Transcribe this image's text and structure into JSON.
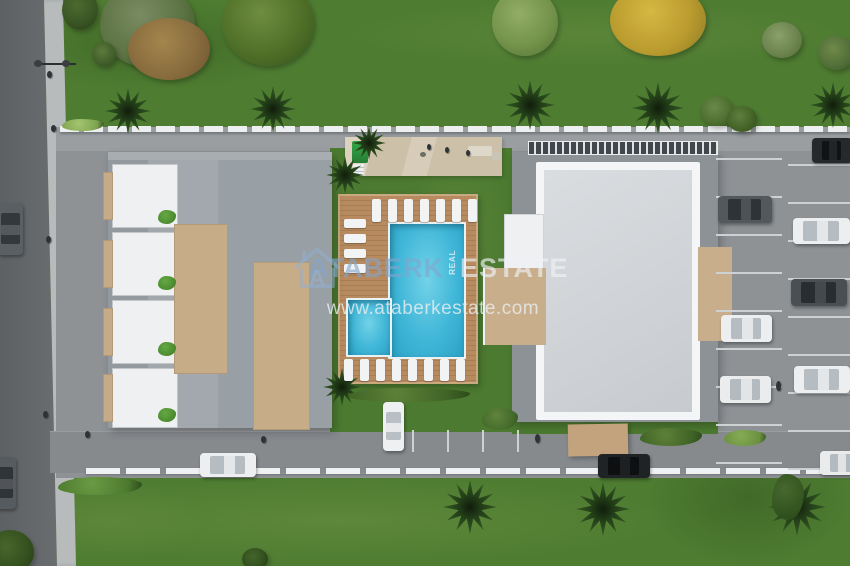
{
  "watermark": {
    "brand_first": "ATABERK",
    "brand_mid_vertical": "REAL",
    "brand_last": "ESTATE",
    "website": "www.ataberkestate.com",
    "logo_letter": "A",
    "brand_first_color": "#82a5cd",
    "brand_last_color": "#eef2f6"
  },
  "scene": {
    "type": "aerial-3d-site-plan-render",
    "description": "Top-down 3D rendering of a residential complex: two buildings, main pool and children's pool on a wooden sun deck with loungers, amenity terrace, parking lots with cars, perimeter roads, lawns, palms and trees",
    "buildings_visible": 2,
    "pools_visible": 2,
    "cars_visible": 13
  },
  "palette": {
    "lawn": "#4e7c31",
    "street": "#66696c",
    "sidewalk": "#b8bbbc",
    "paving": "#8e9295",
    "deck_wood": "#b5885c",
    "pool_water": "#41b7d8",
    "roof_gray": "#9aa0a5",
    "roof_light": "#d4d7da",
    "terrace_tan": "#c9ae8b",
    "fence_white": "#eef0f1"
  },
  "sprites": [
    {
      "cls": "car car-v",
      "name": "car",
      "x": -2,
      "y": 203,
      "w": 25,
      "h": 52,
      "c1": "#5a5f63",
      "cw": "#33383c"
    },
    {
      "cls": "car car-v",
      "name": "car",
      "x": -9,
      "y": 457,
      "w": 25,
      "h": 52,
      "c1": "#565b5f",
      "cw": "#2f3438"
    },
    {
      "cls": "car car-v",
      "name": "car",
      "x": 383,
      "y": 402,
      "w": 21,
      "h": 49,
      "c1": "#eef0f1",
      "cw": "#b9c0c5"
    },
    {
      "cls": "car car-h",
      "name": "car",
      "x": 200,
      "y": 453,
      "w": 56,
      "h": 24,
      "c1": "#eceef0",
      "cw": "#b6bdc2"
    },
    {
      "cls": "car car-h",
      "name": "car",
      "x": 598,
      "y": 454,
      "w": 52,
      "h": 24,
      "c1": "#202326",
      "cw": "#0d0f11"
    },
    {
      "cls": "car car-h",
      "name": "car",
      "x": 820,
      "y": 451,
      "w": 42,
      "h": 24,
      "c1": "#e9ebed",
      "cw": "#b4bbc0"
    },
    {
      "cls": "car car-h",
      "name": "car",
      "x": 718,
      "y": 196,
      "w": 54,
      "h": 27,
      "c1": "#53585c",
      "cw": "#2e3337"
    },
    {
      "cls": "car car-h",
      "name": "car",
      "x": 721,
      "y": 315,
      "w": 51,
      "h": 27,
      "c1": "#eceef0",
      "cw": "#b6bdc2"
    },
    {
      "cls": "car car-h",
      "name": "car",
      "x": 720,
      "y": 376,
      "w": 51,
      "h": 27,
      "c1": "#eaecee",
      "cw": "#b4bbc0"
    },
    {
      "cls": "car car-h",
      "name": "car",
      "x": 812,
      "y": 138,
      "w": 40,
      "h": 25,
      "c1": "#26292c",
      "cw": "#101214"
    },
    {
      "cls": "car car-h",
      "name": "car",
      "x": 793,
      "y": 218,
      "w": 57,
      "h": 26,
      "c1": "#eceef0",
      "cw": "#b6bdc2"
    },
    {
      "cls": "car car-h",
      "name": "car",
      "x": 791,
      "y": 279,
      "w": 56,
      "h": 27,
      "c1": "#4a4f53",
      "cw": "#282d31"
    },
    {
      "cls": "car car-h",
      "name": "car",
      "x": 794,
      "y": 366,
      "w": 56,
      "h": 27,
      "c1": "#eceef0",
      "cw": "#b6bdc2"
    },
    {
      "cls": "palm",
      "name": "palm-tree",
      "x": 105,
      "y": 88,
      "w": 46,
      "h": 46
    },
    {
      "cls": "palm",
      "name": "palm-tree",
      "x": 250,
      "y": 86,
      "w": 46,
      "h": 46
    },
    {
      "cls": "palm",
      "name": "palm-tree",
      "x": 352,
      "y": 126,
      "w": 34,
      "h": 34
    },
    {
      "cls": "palm",
      "name": "palm-tree",
      "x": 505,
      "y": 80,
      "w": 50,
      "h": 50
    },
    {
      "cls": "palm",
      "name": "palm-tree",
      "x": 632,
      "y": 82,
      "w": 52,
      "h": 52
    },
    {
      "cls": "palm",
      "name": "palm-tree",
      "x": 810,
      "y": 82,
      "w": 46,
      "h": 46
    },
    {
      "cls": "palm",
      "name": "palm-tree",
      "x": 326,
      "y": 156,
      "w": 38,
      "h": 38
    },
    {
      "cls": "palm",
      "name": "palm-tree",
      "x": 323,
      "y": 368,
      "w": 38,
      "h": 38
    },
    {
      "cls": "palm",
      "name": "palm-tree",
      "x": 443,
      "y": 480,
      "w": 54,
      "h": 54
    },
    {
      "cls": "palm",
      "name": "palm-tree",
      "x": 576,
      "y": 482,
      "w": 54,
      "h": 54
    },
    {
      "cls": "palm",
      "name": "palm-tree",
      "x": 768,
      "y": 478,
      "w": 58,
      "h": 58
    },
    {
      "cls": "tree",
      "name": "tree",
      "x": 100,
      "y": -18,
      "w": 95,
      "h": 85,
      "c1": "#5d7444",
      "c2": "#7a8b62",
      "c3": "#3d5226"
    },
    {
      "cls": "tree",
      "name": "autumn-tree",
      "x": 128,
      "y": 18,
      "w": 82,
      "h": 62,
      "c1": "#8a6d3e",
      "c2": "#a3854d",
      "c3": "#6b5430"
    },
    {
      "cls": "tree",
      "name": "tree",
      "x": 222,
      "y": -20,
      "w": 92,
      "h": 86,
      "c1": "#4f7028",
      "c2": "#6f8d40",
      "c3": "#35511b"
    },
    {
      "cls": "tree",
      "name": "tree",
      "x": 492,
      "y": -12,
      "w": 66,
      "h": 68,
      "c1": "#74934b",
      "c2": "#93ad66",
      "c3": "#527334"
    },
    {
      "cls": "tree",
      "name": "yellow-tree",
      "x": 610,
      "y": -16,
      "w": 96,
      "h": 72,
      "c1": "#bb9c2f",
      "c2": "#d4b842",
      "c3": "#8f7a24"
    },
    {
      "cls": "tree",
      "name": "bush",
      "x": 762,
      "y": 22,
      "w": 40,
      "h": 36,
      "c1": "#6d8550",
      "c2": "#8ba06b",
      "c3": "#4f6a38"
    },
    {
      "cls": "tree",
      "name": "bush",
      "x": 818,
      "y": 36,
      "w": 36,
      "h": 34,
      "c1": "#54713a",
      "c2": "#70894a",
      "c3": "#3a5526"
    },
    {
      "cls": "tree",
      "name": "small-tree",
      "x": 92,
      "y": 42,
      "w": 24,
      "h": 24,
      "c1": "#44602c",
      "c2": "#5d7a3c",
      "c3": "#2f4a1e"
    },
    {
      "cls": "tree",
      "name": "small-tree",
      "x": 62,
      "y": -10,
      "w": 36,
      "h": 40,
      "c1": "#3a5524",
      "c2": "#4c6a30",
      "c3": "#283e18"
    },
    {
      "cls": "tree",
      "name": "bush",
      "x": 700,
      "y": 96,
      "w": 34,
      "h": 30,
      "c1": "#4e7030",
      "c2": "#68894a",
      "c3": "#365021"
    },
    {
      "cls": "tree",
      "name": "bush",
      "x": 727,
      "y": 106,
      "w": 30,
      "h": 26,
      "c1": "#456428",
      "c2": "#5d7f3e",
      "c3": "#2e481c"
    },
    {
      "cls": "tree",
      "name": "tree",
      "x": -14,
      "y": 530,
      "w": 48,
      "h": 44,
      "c1": "#35511f",
      "c2": "#47662c",
      "c3": "#223a12"
    },
    {
      "cls": "tree",
      "name": "bush",
      "x": 242,
      "y": 548,
      "w": 26,
      "h": 22,
      "c1": "#33501e",
      "c2": "#45652c",
      "c3": "#203812"
    },
    {
      "cls": "hedge",
      "name": "hedge-row",
      "x": 348,
      "y": 388,
      "w": 122,
      "h": 14,
      "c1": "#3f6326",
      "c2": "#5d8038"
    },
    {
      "cls": "hedge",
      "name": "bush",
      "x": 482,
      "y": 408,
      "w": 36,
      "h": 22,
      "c1": "#42682a",
      "c2": "#60843c"
    },
    {
      "cls": "hedge",
      "name": "hedge-row",
      "x": 58,
      "y": 477,
      "w": 84,
      "h": 18,
      "c1": "#4d7a2e",
      "c2": "#6b9a44"
    },
    {
      "cls": "hedge",
      "name": "hedge-row",
      "x": 640,
      "y": 428,
      "w": 62,
      "h": 18,
      "c1": "#3f6326",
      "c2": "#5d8038"
    },
    {
      "cls": "hedge",
      "name": "bush",
      "x": 724,
      "y": 430,
      "w": 42,
      "h": 16,
      "c1": "#6a9040",
      "c2": "#85ab55"
    },
    {
      "cls": "hedge",
      "name": "flower-bed",
      "x": 62,
      "y": 119,
      "w": 42,
      "h": 12,
      "c1": "#7da34f",
      "c2": "#a3c46f"
    },
    {
      "cls": "hedge",
      "name": "bush",
      "x": 772,
      "y": 474,
      "w": 32,
      "h": 46,
      "c1": "#31511e",
      "c2": "#47682e"
    },
    {
      "cls": "hedge",
      "name": "planter",
      "x": 158,
      "y": 210,
      "w": 18,
      "h": 14,
      "c1": "#4a8a2e",
      "c2": "#66a845"
    },
    {
      "cls": "hedge",
      "name": "planter",
      "x": 158,
      "y": 276,
      "w": 18,
      "h": 14,
      "c1": "#4a8a2e",
      "c2": "#66a845"
    },
    {
      "cls": "hedge",
      "name": "planter",
      "x": 158,
      "y": 342,
      "w": 18,
      "h": 14,
      "c1": "#4a8a2e",
      "c2": "#66a845"
    },
    {
      "cls": "hedge",
      "name": "planter",
      "x": 158,
      "y": 408,
      "w": 18,
      "h": 14,
      "c1": "#4a8a2e",
      "c2": "#66a845"
    },
    {
      "cls": "lounger",
      "name": "sun-lounger",
      "x": 372,
      "y": 199,
      "w": 9,
      "h": 23
    },
    {
      "cls": "lounger",
      "name": "sun-lounger",
      "x": 388,
      "y": 199,
      "w": 9,
      "h": 23
    },
    {
      "cls": "lounger",
      "name": "sun-lounger",
      "x": 404,
      "y": 199,
      "w": 9,
      "h": 23
    },
    {
      "cls": "lounger",
      "name": "sun-lounger",
      "x": 420,
      "y": 199,
      "w": 9,
      "h": 23
    },
    {
      "cls": "lounger",
      "name": "sun-lounger",
      "x": 436,
      "y": 199,
      "w": 9,
      "h": 23
    },
    {
      "cls": "lounger",
      "name": "sun-lounger",
      "x": 452,
      "y": 199,
      "w": 9,
      "h": 23
    },
    {
      "cls": "lounger",
      "name": "sun-lounger",
      "x": 468,
      "y": 199,
      "w": 9,
      "h": 23
    },
    {
      "cls": "lounger",
      "name": "sun-lounger",
      "x": 344,
      "y": 219,
      "w": 22,
      "h": 9
    },
    {
      "cls": "lounger",
      "name": "sun-lounger",
      "x": 344,
      "y": 234,
      "w": 22,
      "h": 9
    },
    {
      "cls": "lounger",
      "name": "sun-lounger",
      "x": 344,
      "y": 249,
      "w": 22,
      "h": 9
    },
    {
      "cls": "lounger",
      "name": "sun-lounger",
      "x": 344,
      "y": 264,
      "w": 22,
      "h": 9
    },
    {
      "cls": "lounger",
      "name": "sun-lounger",
      "x": 344,
      "y": 359,
      "w": 9,
      "h": 22
    },
    {
      "cls": "lounger",
      "name": "sun-lounger",
      "x": 360,
      "y": 359,
      "w": 9,
      "h": 22
    },
    {
      "cls": "lounger",
      "name": "sun-lounger",
      "x": 376,
      "y": 359,
      "w": 9,
      "h": 22
    },
    {
      "cls": "lounger",
      "name": "sun-lounger",
      "x": 392,
      "y": 359,
      "w": 9,
      "h": 22
    },
    {
      "cls": "lounger",
      "name": "sun-lounger",
      "x": 408,
      "y": 359,
      "w": 9,
      "h": 22
    },
    {
      "cls": "lounger",
      "name": "sun-lounger",
      "x": 424,
      "y": 359,
      "w": 9,
      "h": 22
    },
    {
      "cls": "lounger",
      "name": "sun-lounger",
      "x": 440,
      "y": 359,
      "w": 9,
      "h": 22
    },
    {
      "cls": "lounger",
      "name": "sun-lounger",
      "x": 456,
      "y": 359,
      "w": 9,
      "h": 22
    },
    {
      "cls": "person",
      "name": "pedestrian",
      "x": 47,
      "y": 71,
      "w": 5,
      "h": 7
    },
    {
      "cls": "person",
      "name": "pedestrian",
      "x": 51,
      "y": 125,
      "w": 5,
      "h": 7
    },
    {
      "cls": "person",
      "name": "pedestrian",
      "x": 46,
      "y": 236,
      "w": 5,
      "h": 7
    },
    {
      "cls": "person",
      "name": "pedestrian",
      "x": 43,
      "y": 411,
      "w": 5,
      "h": 7
    },
    {
      "cls": "person",
      "name": "pedestrian",
      "x": 85,
      "y": 431,
      "w": 5,
      "h": 7
    },
    {
      "cls": "person",
      "name": "pedestrian",
      "x": 261,
      "y": 436,
      "w": 5,
      "h": 7
    },
    {
      "cls": "person",
      "name": "pedestrian",
      "x": 427,
      "y": 144,
      "w": 4,
      "h": 6
    },
    {
      "cls": "person",
      "name": "pedestrian",
      "x": 445,
      "y": 147,
      "w": 4,
      "h": 6
    },
    {
      "cls": "person",
      "name": "pedestrian",
      "x": 466,
      "y": 150,
      "w": 4,
      "h": 6
    },
    {
      "cls": "person",
      "name": "cyclist",
      "x": 535,
      "y": 434,
      "w": 5,
      "h": 9
    },
    {
      "cls": "person",
      "name": "scooter",
      "x": 776,
      "y": 381,
      "w": 5,
      "h": 10
    }
  ]
}
